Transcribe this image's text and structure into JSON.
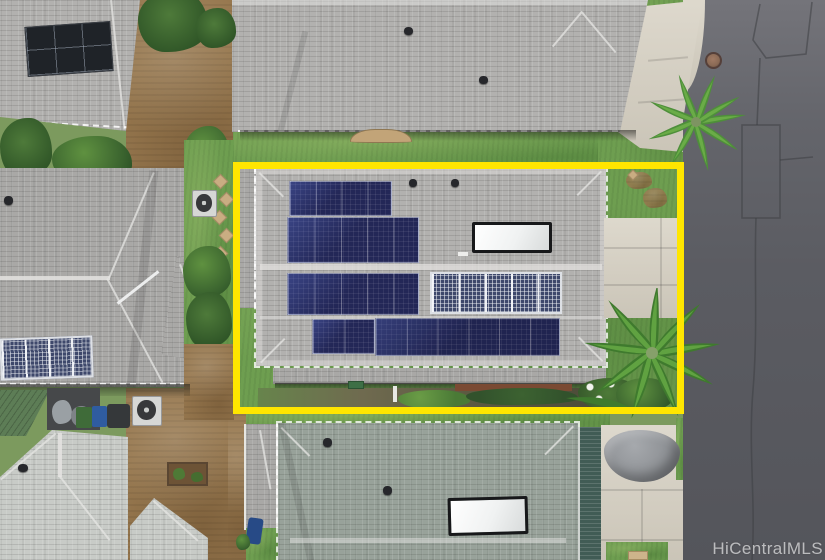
{
  "image": {
    "kind": "aerial drone photo of residential neighborhood",
    "width_px": 825,
    "height_px": 560
  },
  "watermark": {
    "text": "HiCentralMLS"
  },
  "highlight": {
    "shape": "rectangle",
    "purpose": "outlines the subject property for the listing",
    "color": "#ffe600"
  },
  "subject_property": {
    "rooftop_solar_panel_arrays": 6,
    "solar_water_heater_panels": 1,
    "roof_vents": 2,
    "landscaping": [
      "front lawn",
      "palm tree",
      "hedge row with white flowers",
      "concrete patio"
    ]
  },
  "neighborhood": {
    "visible_house_roofs": 6,
    "street": {
      "surface": "asphalt",
      "features": [
        "manhole cover",
        "utility patch seams",
        "long pavement crack",
        "curved curb"
      ]
    },
    "other_objects": [
      "car under gray cover",
      "air-conditioner units",
      "trash and recycle bins",
      "stepping stones",
      "garden beds",
      "green metal shed roof",
      "black solar array",
      "white-grid solar arrays"
    ]
  },
  "colors": {
    "highlight": "#ffe600",
    "watermarkcolor": "rgba(255,255,255,0.62)",
    "road": "#5b5c62",
    "roadlight": "#74747a",
    "concrete": "#d7d1c3",
    "grass": "#6e9e50",
    "dirt": "#97784f",
    "roofgray": "#b2b1af",
    "roofgray2": "#a9a8a6",
    "roofgreen": "#98a29a",
    "roofwhite": "#c8cbc7",
    "metalgreen": "#5d7d56",
    "panelnavy": "#232757",
    "panelgridbg": "#3e486b",
    "tarp": "#8f9296",
    "manhole": "#8a6a55",
    "mulch": "#7a4a33",
    "hedge": "#32522c"
  }
}
